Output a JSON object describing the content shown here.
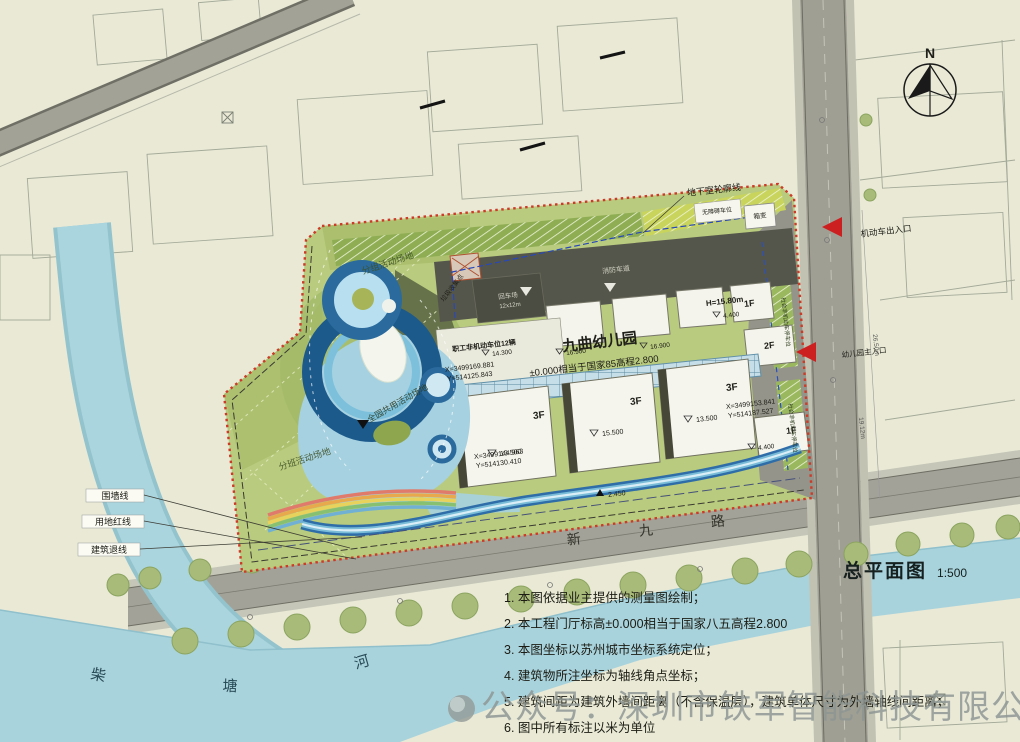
{
  "titleblock": {
    "title": "总平面图",
    "scale": "1:500"
  },
  "compass": {
    "north": "N"
  },
  "roads": {
    "char1": "新",
    "char2": "九",
    "char3": "路"
  },
  "river": {
    "char1": "柴",
    "char2": "塘",
    "char3": "河"
  },
  "site": {
    "name": "九曲幼儿园",
    "datum": "±0.000相当于国家85高程2.800",
    "height": "H=15.80m"
  },
  "areas": {
    "group_activity": "分组活动场地",
    "shared_activity": "全园共用活动场地",
    "class_activity": "分班活动场地"
  },
  "facilities": {
    "staff_parking": "职工非机动车位12辆",
    "fire_lane": "消防车道",
    "turnaround": "回车场",
    "turnaround_size": "12x12m",
    "garbage": "垃圾收集点",
    "accessible_parking": "无障碍车位",
    "transformer": "箱变",
    "public_bike_parking": "社会非机动车停车位",
    "basement_outline": "地下室轮廓线"
  },
  "entrances": {
    "vehicle": "机动车出入口",
    "main": "幼儿园主入口"
  },
  "boundary_labels": {
    "fence": "围墙线",
    "red_line": "用地红线",
    "setback": "建筑退线"
  },
  "floors": {
    "f3": "3F",
    "f2": "2F",
    "f1": "1F"
  },
  "elevations": {
    "e15500": "15.500",
    "e13500": "13.500",
    "e14300": "14.300",
    "e16900": "16.900",
    "e4400": "4.400",
    "e2450": "2.450"
  },
  "coordinates": {
    "c1x": "X=3499169.881",
    "c1y": "Y=514125.843",
    "c2x": "X=3499144.963",
    "c2y": "Y=514130.410",
    "c3x": "X=3499153.841",
    "c3y": "Y=514187.527"
  },
  "dimensions": {
    "d1": "26.50m",
    "d2": "19.12m"
  },
  "notes": {
    "n1": "1. 本图依据业主提供的测量图绘制；",
    "n2": "2. 本工程门厅标高±0.000相当于国家八五高程2.800",
    "n3": "3. 本图坐标以苏州城市坐标系统定位；",
    "n4": "4. 建筑物所注坐标为轴线角点坐标；",
    "n5": "5. 建筑间距为建筑外墙间距离（不含保温层），建筑单体尺寸为外墙轴线间距离；",
    "n6": "6. 图中所有标注以米为单位"
  },
  "watermark": {
    "text": "公众号：深圳市铁军智能科技有限公司"
  },
  "colors": {
    "boundary_red": "#cc3b28",
    "water": "#a9d3dc",
    "lawn": "#b9cb7e",
    "roof_dark": "#55564b",
    "ring_blue": "#1d5a8c",
    "canopy": "#c6dee8"
  }
}
